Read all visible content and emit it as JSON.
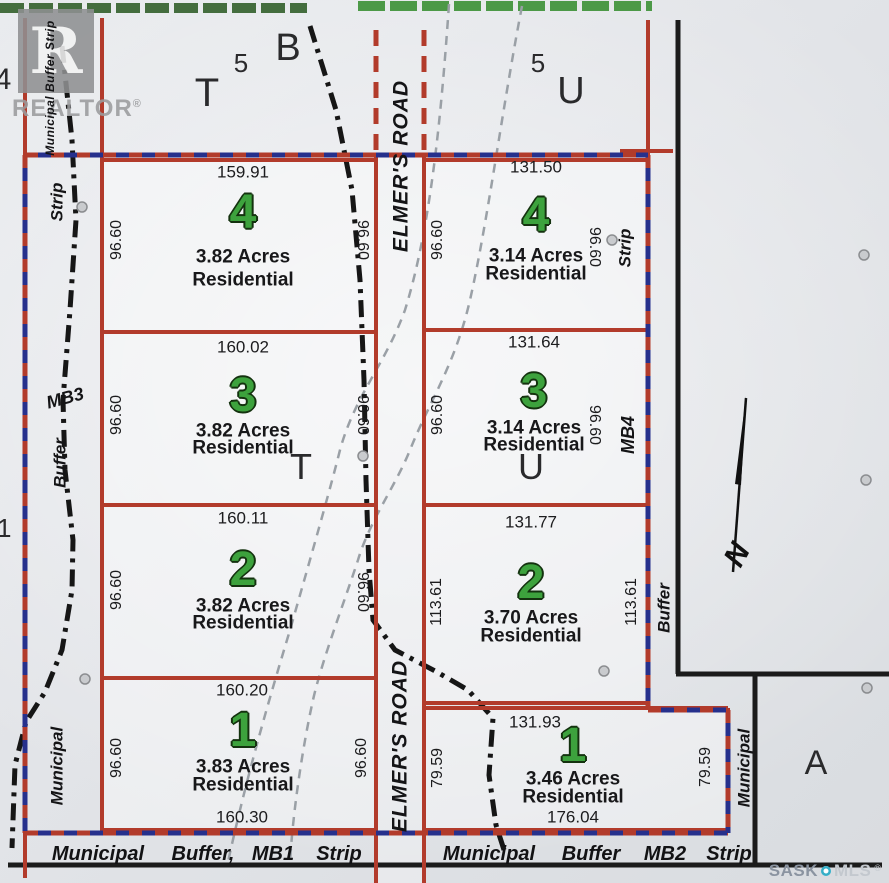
{
  "title": "Subdivision plat sign - Elmer's Road residential lots",
  "road_label": "ELMER'S ROAD",
  "lots": [
    {
      "number": "4",
      "acres": "3.82 Acres",
      "zoning": "Residential",
      "top": "159.91",
      "side_left": "96.60",
      "side_right": "96.60"
    },
    {
      "number": "3",
      "acres": "3.82 Acres",
      "zoning": "Residential",
      "top": "160.02",
      "side_left": "96.60",
      "side_right": "96.60"
    },
    {
      "number": "2",
      "acres": "3.82 Acres",
      "zoning": "Residential",
      "top": "160.11",
      "side_left": "96.60",
      "side_right": "96.60"
    },
    {
      "number": "1",
      "acres": "3.83 Acres",
      "zoning": "Residential",
      "top": "160.20",
      "bottom": "160.30",
      "side_left": "96.60",
      "side_right": "96.60"
    },
    {
      "number": "4",
      "acres": "3.14 Acres",
      "zoning": "Residential",
      "top": "131.50",
      "side_left": "96.60",
      "side_right": "96.60"
    },
    {
      "number": "3",
      "acres": "3.14 Acres",
      "zoning": "Residential",
      "top": "131.64",
      "side_left": "96.60",
      "side_right": "96.60"
    },
    {
      "number": "2",
      "acres": "3.70 Acres",
      "zoning": "Residential",
      "top": "131.77",
      "side_left": "113.61",
      "side_right": "113.61"
    },
    {
      "number": "1",
      "acres": "3.46 Acres",
      "zoning": "Residential",
      "top": "131.93",
      "bottom": "176.04",
      "side_left": "79.59",
      "side_right": "79.59"
    }
  ],
  "side_dims": [
    "96.60",
    "96.60",
    "96.60",
    "96.60",
    "96.60",
    "96.60",
    "96.60",
    "96.60",
    "96.60",
    "96.60",
    "113.61",
    "79.59",
    "96.60",
    "96.60",
    "113.61",
    "79.59"
  ],
  "letters": [
    "T",
    "5",
    "B",
    "5",
    "U",
    "T",
    "U",
    "A",
    "4",
    "11"
  ],
  "margin_labels": [
    "Municipal  Buffer  Strip",
    "Strip",
    "MB3",
    "Buffer",
    "Municipal",
    "Strip",
    "MB4",
    "Buffer",
    "Municipal"
  ],
  "bottom_rows": [
    [
      "Municipal",
      "Buffer,",
      "MB1",
      "Strip"
    ],
    [
      "Municipal",
      "Buffer",
      "MB2",
      "Strip"
    ]
  ],
  "compass": {
    "north": "N"
  },
  "logo": {
    "letter": "R",
    "brand": "REALTOR",
    "reg": "®"
  },
  "watermark": {
    "sask": "SASK",
    "mls": "MLS",
    "reg": "®"
  },
  "colors": {
    "lot_line_red": "#b23b2b",
    "border_blue": "#26308c",
    "lot_number_green": "#3da23d",
    "green_band_dark": "#33602c",
    "green_band_bright": "#44953f",
    "trail_gray": "#9aa0a6",
    "boundary_black": "#1b1b1b"
  }
}
